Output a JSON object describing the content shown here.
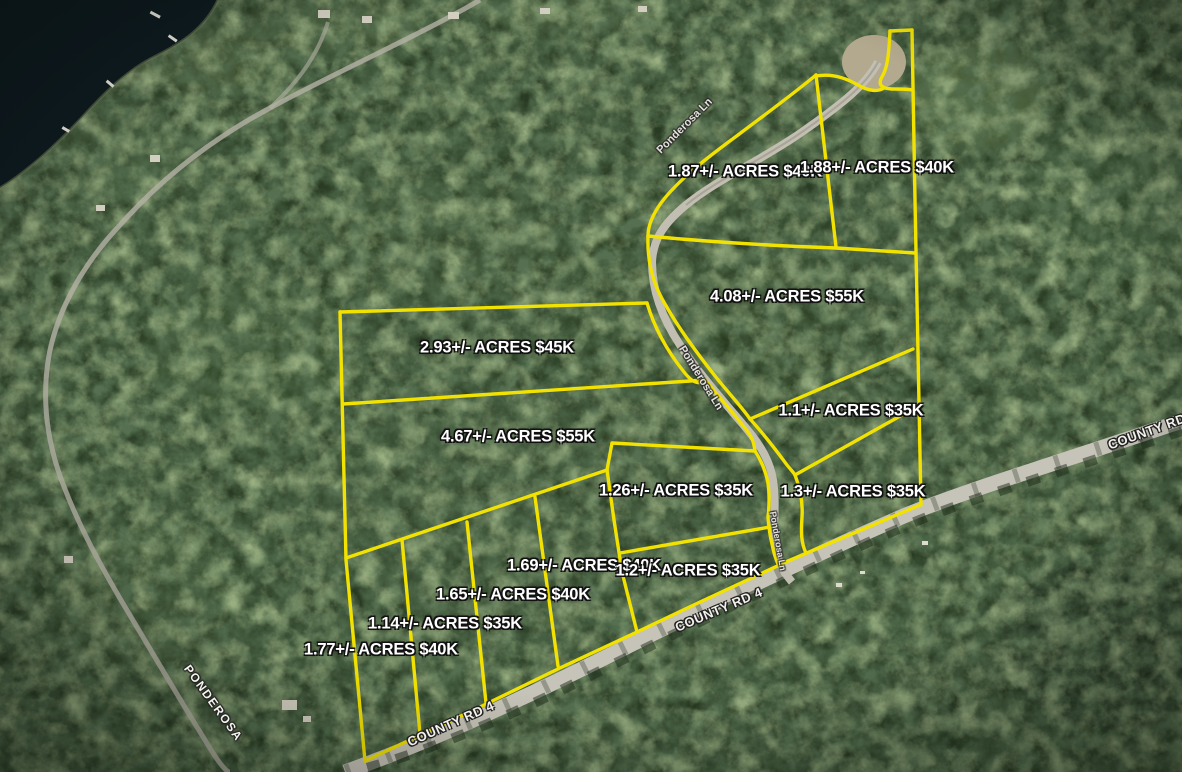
{
  "map": {
    "type": "aerial-parcel-map",
    "parcels": [
      {
        "acres": "1.87",
        "price": "$40K",
        "label": "1.87+/- ACRES $40K"
      },
      {
        "acres": "1.88",
        "price": "$40K",
        "label": "1.88+/- ACRES $40K"
      },
      {
        "acres": "4.08",
        "price": "$55K",
        "label": "4.08+/- ACRES $55K"
      },
      {
        "acres": "2.93",
        "price": "$45K",
        "label": "2.93+/- ACRES $45K"
      },
      {
        "acres": "1.1",
        "price": "$35K",
        "label": "1.1+/- ACRES $35K"
      },
      {
        "acres": "4.67",
        "price": "$55K",
        "label": "4.67+/- ACRES $55K"
      },
      {
        "acres": "1.26",
        "price": "$35K",
        "label": "1.26+/- ACRES $35K"
      },
      {
        "acres": "1.3",
        "price": "$35K",
        "label": "1.3+/- ACRES $35K"
      },
      {
        "acres": "1.69",
        "price": "$40K",
        "label": "1.69+/- ACRES $40K"
      },
      {
        "acres": "1.2",
        "price": "$35K",
        "label": "1.2+/- ACRES $35K"
      },
      {
        "acres": "1.65",
        "price": "$40K",
        "label": "1.65+/- ACRES $40K"
      },
      {
        "acres": "1.14",
        "price": "$35K",
        "label": "1.14+/- ACRES $35K"
      },
      {
        "acres": "1.77",
        "price": "$40K",
        "label": "1.77+/- ACRES $40K"
      }
    ],
    "road_labels": {
      "ponderosa_top": "Ponderosa Ln",
      "ponderosa_mid": "Ponderosa Ln",
      "ponderosa_lower": "Ponderosa Ln",
      "county_rd_bottom": "COUNTY RD 4",
      "county_rd_mid": "COUNTY RD 4",
      "county_rd_right": "COUNTY RD",
      "ponderosa_sw": "PONDEROSA"
    },
    "colors": {
      "parcel_line": "#f2e202",
      "label_text": "#ffffff",
      "label_outline": "#111111",
      "road_surface": "#c6c3b8",
      "water": "#0e1b20"
    }
  }
}
